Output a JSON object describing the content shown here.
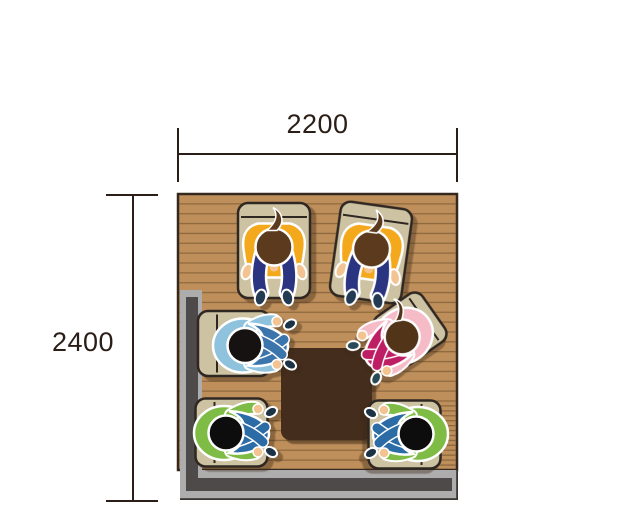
{
  "diagram": {
    "type": "room-floor-plan-top-view",
    "description": "Top-down illustration of six people seated on floor cushions around a low table in a room",
    "room": {
      "width_mm": "2200",
      "depth_mm": "2400"
    }
  },
  "dimensions": {
    "horizontal": {
      "label": "2200"
    },
    "vertical": {
      "label": "2400"
    }
  },
  "palette": {
    "line": "#2B1D17",
    "floor": "#BE8F5B",
    "plank": "#8F6A3F",
    "floor_outline": "#35281E",
    "wall_light": "#ADADAD",
    "wall_dark": "#4D4A49",
    "wall_edge": "#3A3633",
    "table": "#442D1D",
    "cushion": "#CDC2A2",
    "cushion_outline": "#2F2721",
    "body_outline": "#FFFFFF"
  },
  "table": {
    "name": "low-table",
    "x": 281,
    "y": 348,
    "w": 91,
    "h": 92
  },
  "people": [
    {
      "id": "person-top-left",
      "pose": "seiza",
      "facing": "down",
      "x": 274,
      "y": 250.5,
      "rot": 0,
      "mirror": false,
      "cushion": {
        "w": 72,
        "h": 95,
        "dx": 0,
        "dy": 0
      },
      "shirt": "#F4A81B",
      "pants": "#2B3480",
      "hair": "#5B3A1D",
      "skin": "#F3C491",
      "feet": "#233B52",
      "ponytail": false
    },
    {
      "id": "person-top-right",
      "pose": "seiza",
      "facing": "down",
      "x": 371,
      "y": 252.5,
      "rot": 8,
      "mirror": false,
      "cushion": {
        "w": 72,
        "h": 95,
        "dx": 0,
        "dy": 0
      },
      "shirt": "#F4A81B",
      "pants": "#2B3480",
      "hair": "#5B3A1D",
      "skin": "#F3C491",
      "feet": "#233B52",
      "ponytail": false
    },
    {
      "id": "person-left-blue",
      "pose": "cross",
      "facing": "right",
      "x": 234,
      "y": 343.5,
      "rot": 0,
      "mirror": false,
      "cushion": {
        "w": 72,
        "h": 65,
        "dx": 0,
        "dy": 0
      },
      "shirt": "#8FC3DD",
      "pants": "#3C74AC",
      "hair": "#161211",
      "skin": "#F3C491",
      "feet": "#1C3346",
      "ponytail": false
    },
    {
      "id": "person-right-pink",
      "pose": "cross",
      "facing": "down-left",
      "x": 410,
      "y": 329,
      "rot": -35,
      "mirror": true,
      "cushion": {
        "w": 58,
        "h": 58,
        "dx": 0,
        "dy": 0
      },
      "shirt": "#F5BCC8",
      "pants": "#BE1E63",
      "hair": "#523419",
      "skin": "#F3C491",
      "feet": "#2A4A55",
      "ponytail": true
    },
    {
      "id": "person-bottom-left-green",
      "pose": "cross",
      "facing": "right",
      "x": 215,
      "y": 431,
      "rot": 0,
      "mirror": false,
      "cushion": {
        "w": 72,
        "h": 68,
        "dx": 16.5,
        "dy": 1.5
      },
      "shirt": "#7FBC45",
      "pants": "#2B6CA6",
      "hair": "#0D0D0D",
      "skin": "#F3C491",
      "feet": "#1C3346",
      "ponytail": false
    },
    {
      "id": "person-bottom-right-green",
      "pose": "cross",
      "facing": "left",
      "x": 427,
      "y": 432,
      "rot": 0,
      "mirror": true,
      "cushion": {
        "w": 72,
        "h": 68,
        "dx": 22.5,
        "dy": 2.5
      },
      "shirt": "#7FBC45",
      "pants": "#2B6CA6",
      "hair": "#0D0D0D",
      "skin": "#F3C491",
      "feet": "#1C3346",
      "ponytail": false
    }
  ]
}
